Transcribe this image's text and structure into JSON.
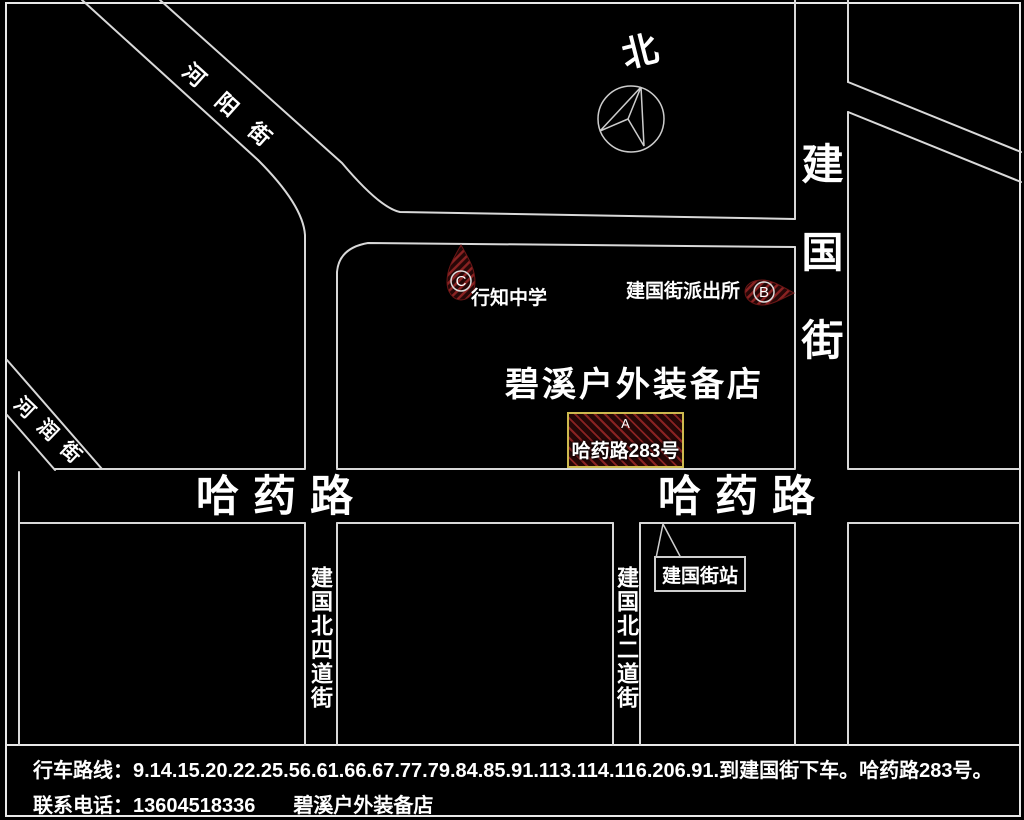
{
  "map": {
    "compass_label": "北",
    "streets": {
      "heyang": "河阳街",
      "herun": "河润街",
      "jianguo": "建国街",
      "hayao_left": "哈药路",
      "hayao_right": "哈药路",
      "jianguo_n4": "建国北四道街",
      "jianguo_n2": "建国北二道街"
    },
    "markers": {
      "a": {
        "letter": "A",
        "address": "哈药路283号"
      },
      "b": {
        "letter": "B",
        "label": "建国街派出所"
      },
      "c": {
        "letter": "C",
        "label": "行知中学"
      }
    },
    "store_name": "碧溪户外装备店",
    "bus_stop_label": "建国街站"
  },
  "footer": {
    "route_line": "行车路线：9.14.15.20.22.25.56.61.66.67.77.79.84.85.91.113.114.116.206.91.到建国街下车。哈药路283号。",
    "contact_label": "联系电话：",
    "phone": "13604518336",
    "store_name": "碧溪户外装备店"
  },
  "colors": {
    "background": "#000000",
    "road_line": "#d9d9d9",
    "marker_hatch_red": "#8a2222",
    "address_box_border": "#cdb94e",
    "text": "#ffffff"
  }
}
